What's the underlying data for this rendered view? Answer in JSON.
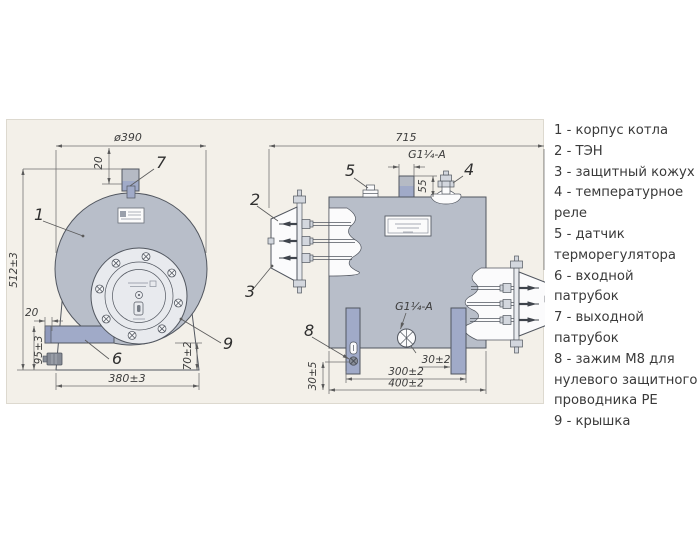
{
  "drawing": {
    "front_view": {
      "dim_diameter": "ø390",
      "dim_pipe_offset": "20",
      "dim_height": "512±3",
      "dim_inlet_offset": "20",
      "dim_inlet_height": "95±3",
      "dim_cover_floor": "70±2",
      "dim_base_width": "380±3"
    },
    "side_view": {
      "dim_length": "715",
      "dim_outlet_thread": "G1¼-A",
      "dim_outlet_height": "55",
      "dim_inlet_thread": "G1¼-A",
      "dim_leg_inset": "30±2",
      "dim_leg_span": "300±2",
      "dim_base_length": "400±2",
      "dim_clamp_height": "30±5"
    },
    "callouts": {
      "c1": "1",
      "c2": "2",
      "c3": "3",
      "c4": "4",
      "c5": "5",
      "c6": "6",
      "c7": "7",
      "c8": "8",
      "c9": "9"
    }
  },
  "legend": {
    "items": [
      "1 - корпус котла",
      "2 - ТЭН",
      "3 - защитный кожух",
      "4 - температурное реле",
      "5 - датчик терморегулятора",
      "6 - входной патрубок",
      "7 - выходной патрубок",
      "8 - зажим М8 для нулевого защитного проводника РЕ",
      "9 - крышка"
    ]
  }
}
